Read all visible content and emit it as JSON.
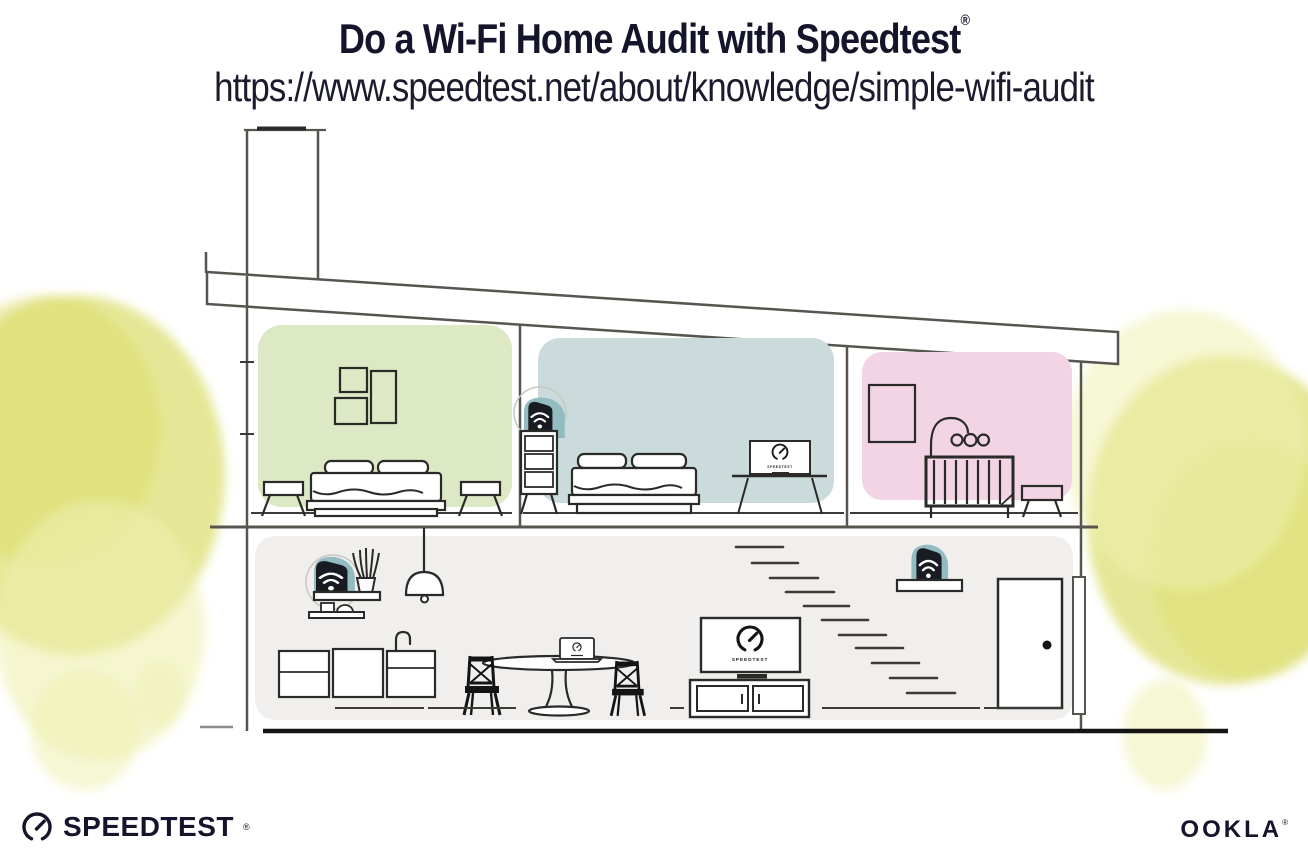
{
  "header": {
    "title": "Do a Wi-Fi Home Audit with Speedtest",
    "registered_mark": "®",
    "url": "https://www.speedtest.net/about/knowledge/simple-wifi-audit"
  },
  "illustration": {
    "living_room_tv_label": "SPEEDTEST",
    "bedroom_tv_label": "SPEEDTEST",
    "colors": {
      "ink": "#14152a",
      "house_line_gray": "#57554f",
      "furniture_line": "#2a2a28",
      "bedroom_green": "#dde8c5",
      "bedroom_blue": "#cbdbdc",
      "nursery_pink": "#f3d4e4",
      "ground_floor_gray": "#f1efed",
      "tree_yellow": "#dfe17c",
      "device_teal": "#93bcc2",
      "device_dark": "#191b22"
    },
    "icons": {
      "router": "wifi-router-icon",
      "gauge": "speedtest-gauge-icon"
    }
  },
  "footer": {
    "speedtest_wordmark": "SPEEDTEST",
    "speedtest_registered_mark": "®",
    "ookla_wordmark": "OOKLA",
    "ookla_registered_mark": "®"
  }
}
